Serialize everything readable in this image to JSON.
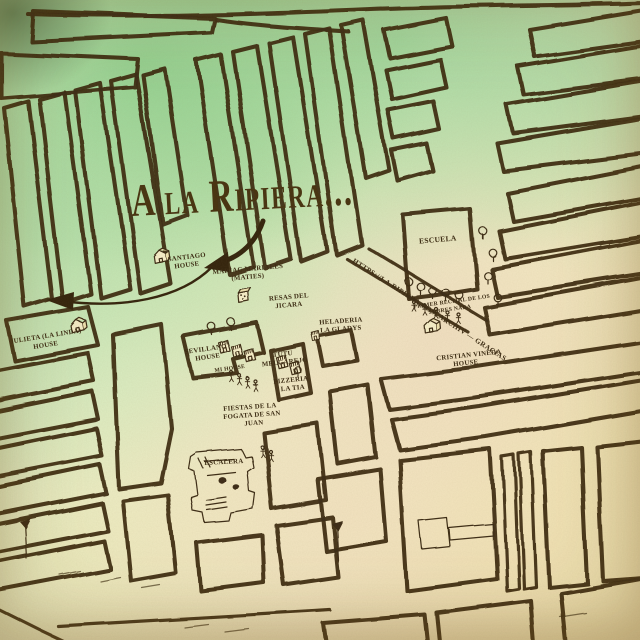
{
  "title": {
    "text": "A la Ripiera..."
  },
  "colors": {
    "ink": "#3a2a12",
    "title_ink": "#46320f",
    "paper_green": "#cdeec2",
    "paper_cream": "#f1ecc6",
    "paper_warm": "#eedfae"
  },
  "labels": {
    "julieta": {
      "line1": "Julieta (La Linda)",
      "line2": "House"
    },
    "santiago": {
      "line1": "Santiago",
      "line2": "House"
    },
    "mariac": {
      "line1": "Mariac Mariales",
      "line2": "(Maties)"
    },
    "resas": {
      "line1": "Resas del",
      "line2": "Jicara"
    },
    "heladeria": {
      "line1": "Heladeria",
      "line2": "La Gladys"
    },
    "escuela": {
      "line1": "Escuela"
    },
    "recital": {
      "line1": "Primer Recital de los",
      "line2": "Sobres Nada"
    },
    "street_url": {
      "line1": "https://la.ripiera.com/archiv — Gracias"
    },
    "cristian": {
      "line1": "Cristian Vineda",
      "line2": "House"
    },
    "sevillano": {
      "line1": "Sevillano",
      "line2": "House"
    },
    "mi_house": {
      "line1": "Mi House"
    },
    "tutu": {
      "line1": "Tutu",
      "line2": "Melgarejo"
    },
    "pizzeria": {
      "line1": "Pizzeria",
      "line2": "La Tia"
    },
    "fiestas": {
      "line1": "Fiestas de la",
      "line2": "Fogata de San",
      "line3": "Juan"
    },
    "escalera": {
      "line1": "Escalera"
    }
  },
  "icons": {
    "house": "house-icon",
    "dice_house": "dice-house-icon",
    "tree": "tree-icon",
    "person": "person-icon",
    "shop": "shop-icon",
    "castle": "castle-icon",
    "key_building": "key-building-icon",
    "lamppost": "lamppost-icon",
    "shore_dash": "shore-dash",
    "arrow": "curved-arrow"
  }
}
